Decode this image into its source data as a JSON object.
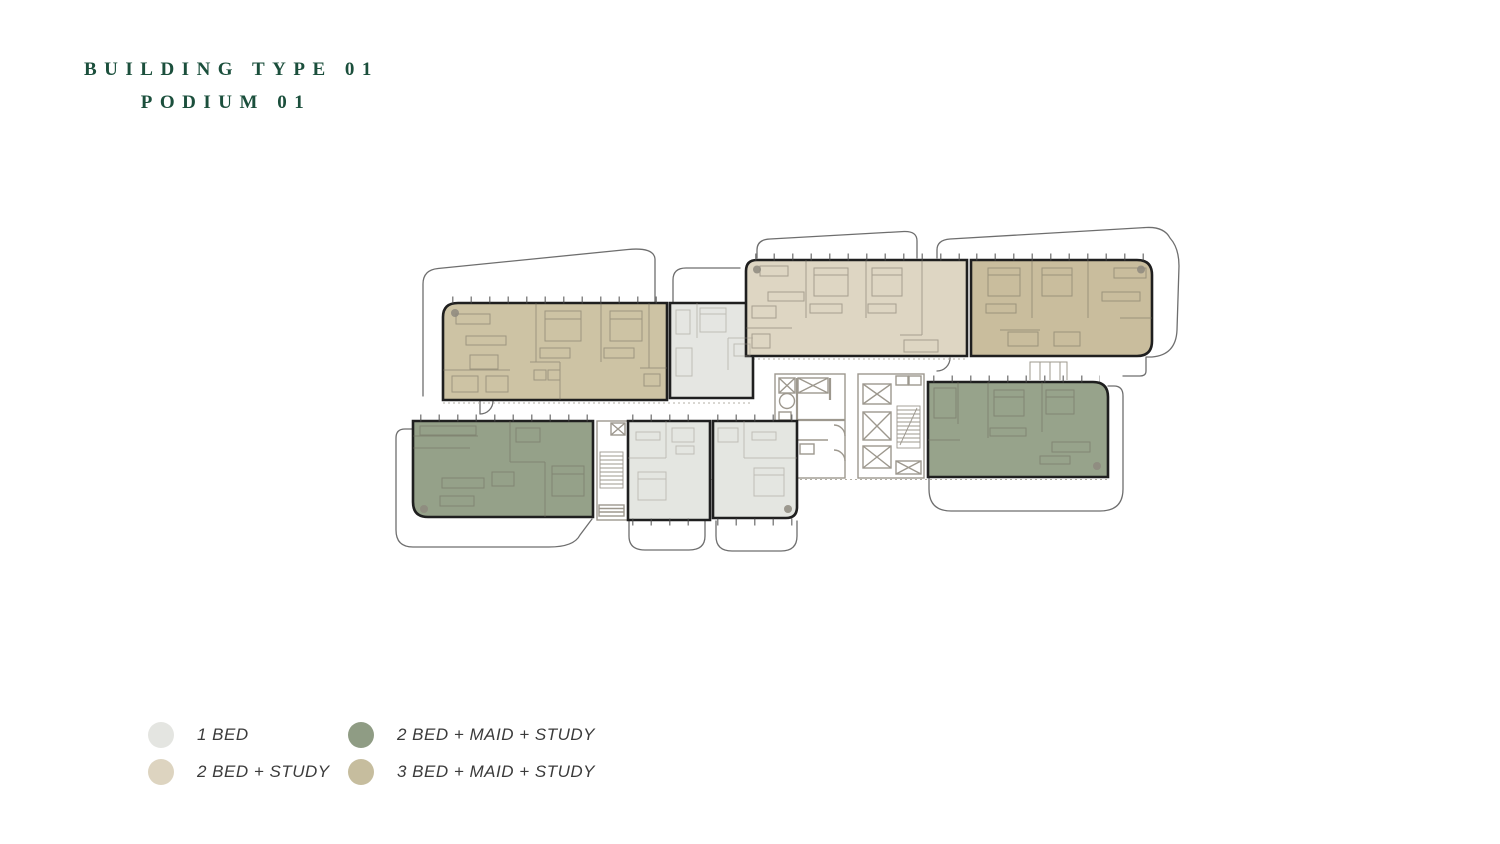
{
  "title": {
    "line1": "BUILDING TYPE 01",
    "line2": "PODIUM 01"
  },
  "legend": {
    "items": [
      {
        "label": "1 BED",
        "color": "#e4e5e1"
      },
      {
        "label": "2 BED + STUDY",
        "color": "#ddd4c0"
      },
      {
        "label": "2 BED + MAID + STUDY",
        "color": "#8f9c84"
      },
      {
        "label": "3 BED + MAID + STUDY",
        "color": "#c6bd9e"
      }
    ]
  },
  "palette": {
    "title_green": "#1b4f3c",
    "unit_border": "#1f1f1f",
    "balcony_outline": "#6e6e6e",
    "wall_gray": "#9d988e",
    "legend_text": "#3b3b3b",
    "background": "#ffffff"
  },
  "floorplan": {
    "units": [
      {
        "id": "top-left",
        "type": "3 BED + MAID + STUDY",
        "color": "#cdc3a4"
      },
      {
        "id": "top-left-small",
        "type": "1 BED",
        "color": "#e5e6e2"
      },
      {
        "id": "top-middle",
        "type": "2 BED + STUDY",
        "color": "#ded6c3"
      },
      {
        "id": "top-right",
        "type": "3 BED + MAID + STUDY",
        "color": "#c9bd9d"
      },
      {
        "id": "bottom-left",
        "type": "2 BED + MAID + STUDY",
        "color": "#95a189"
      },
      {
        "id": "bottom-middle-1",
        "type": "1 BED",
        "color": "#e4e6e1"
      },
      {
        "id": "bottom-middle-2",
        "type": "1 BED",
        "color": "#e4e6e1"
      },
      {
        "id": "middle-right",
        "type": "2 BED + MAID + STUDY",
        "color": "#97a38b"
      }
    ]
  }
}
